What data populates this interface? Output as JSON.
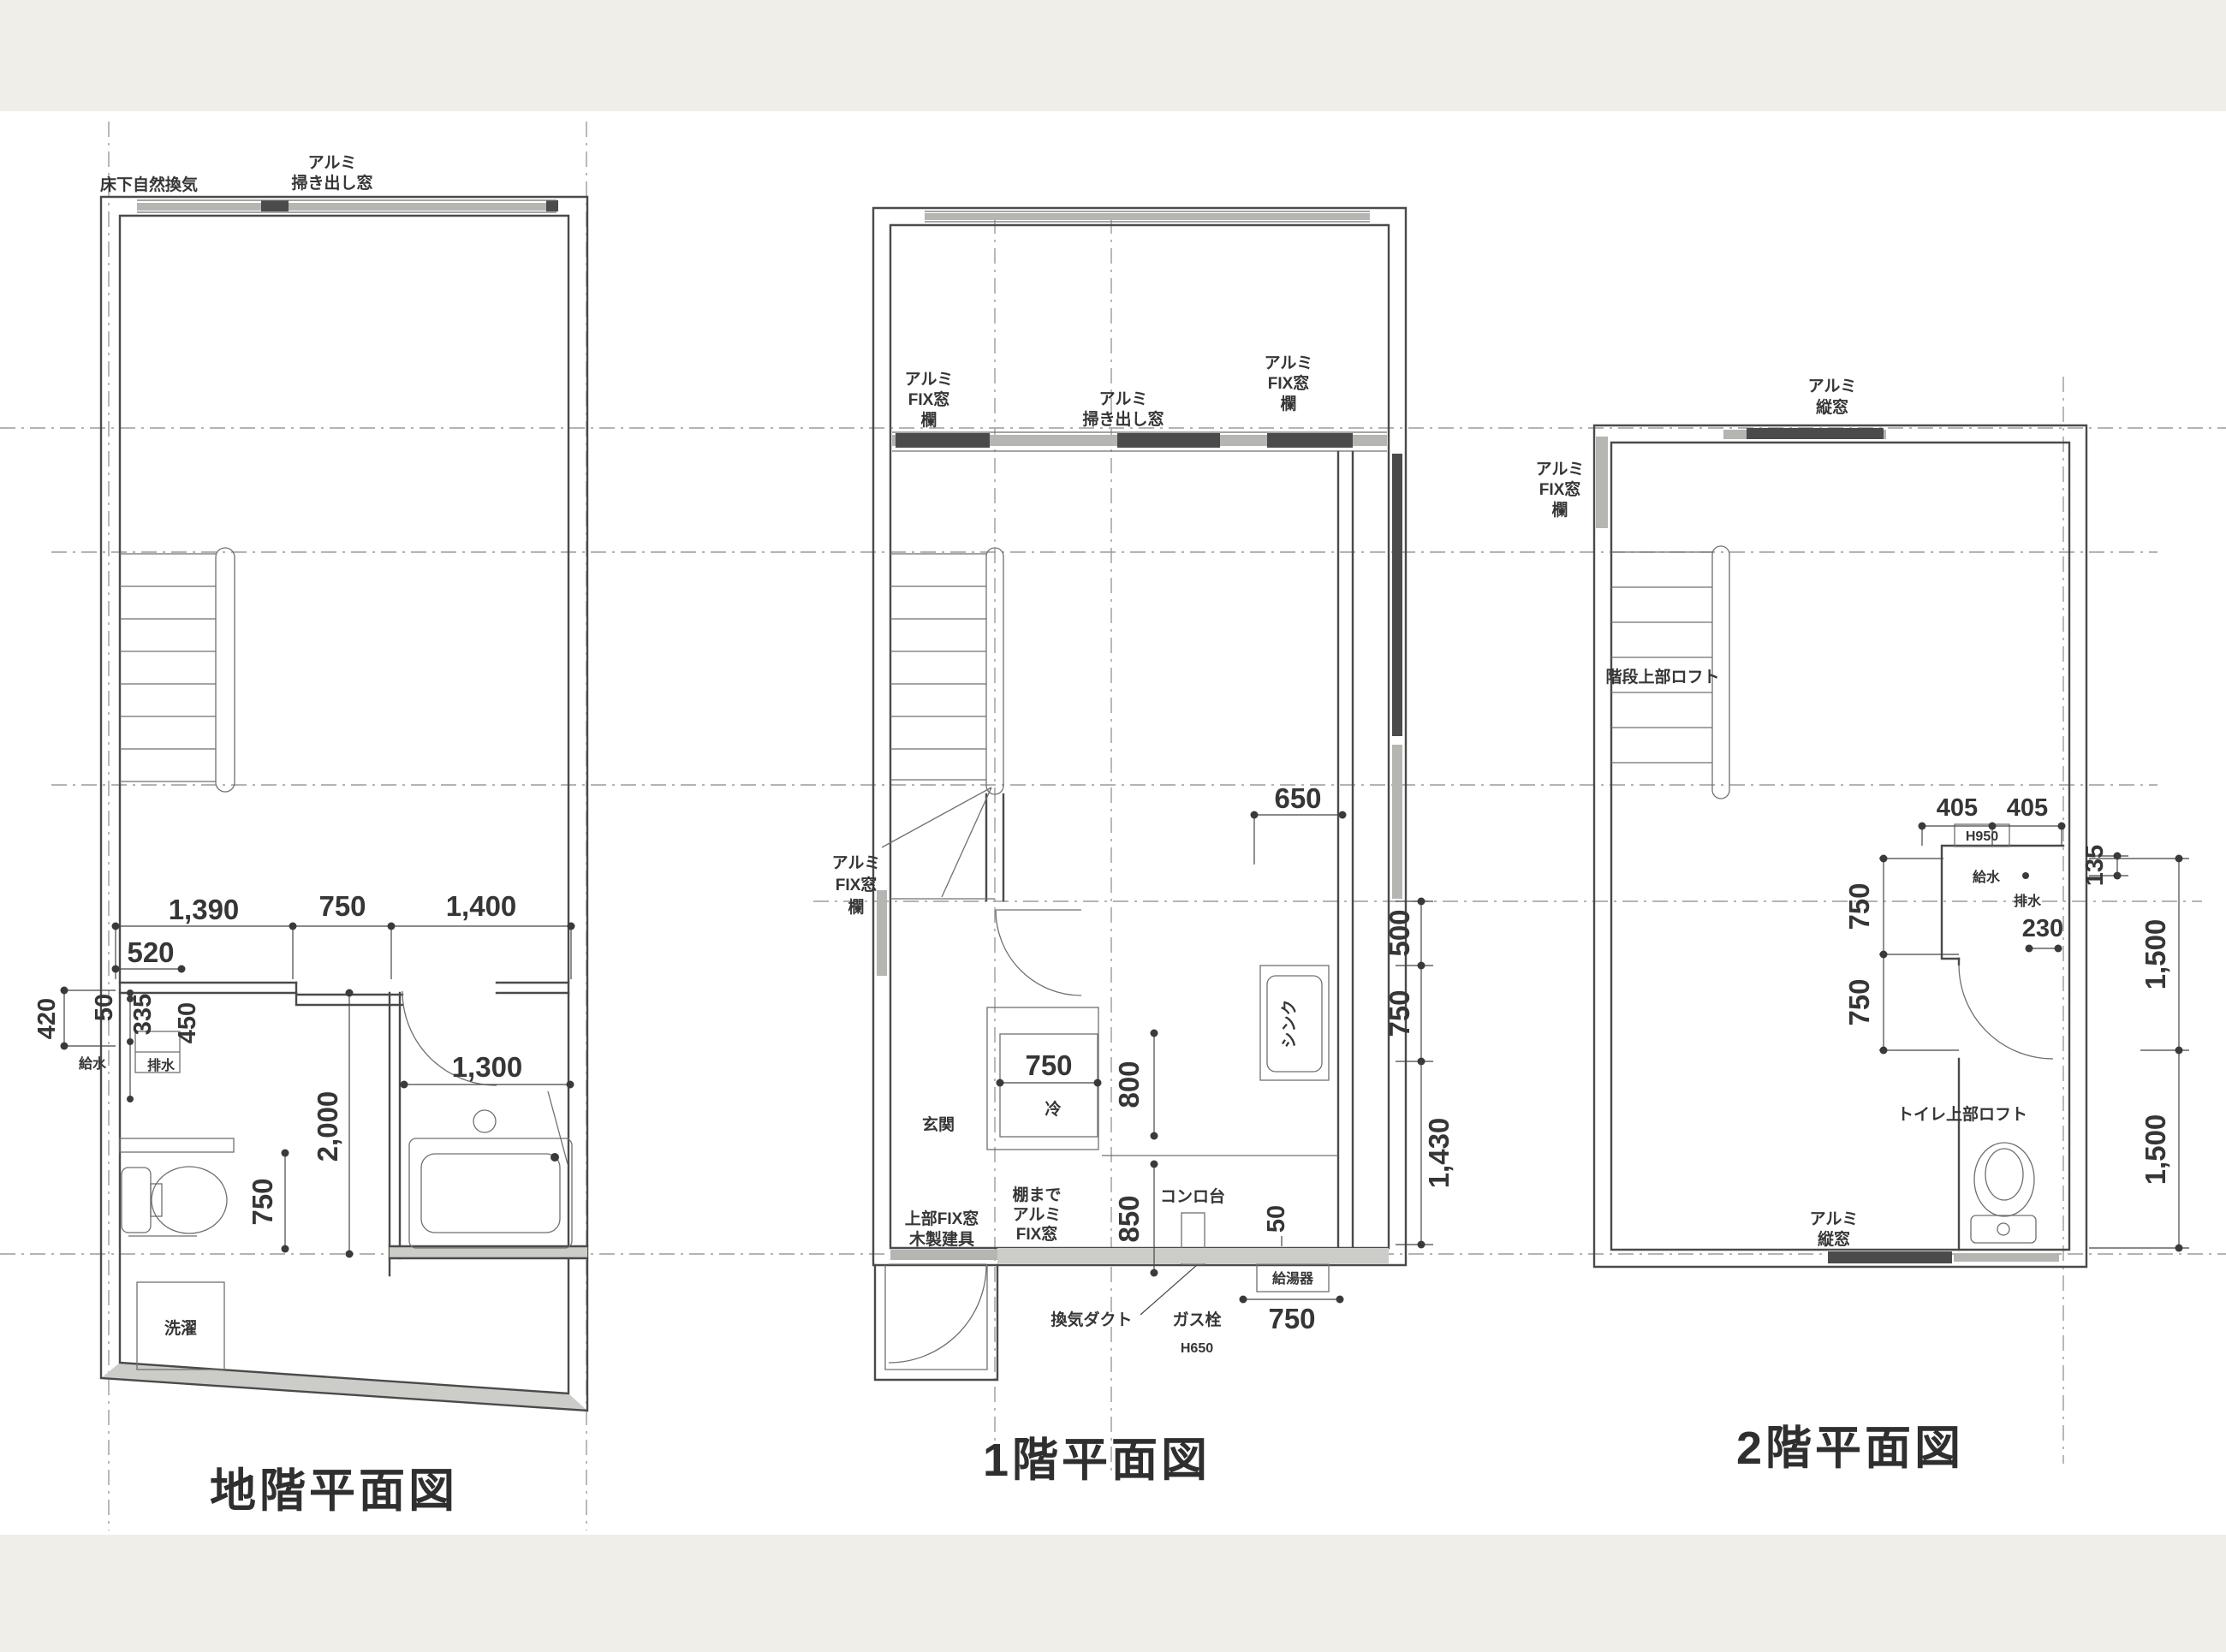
{
  "common": {
    "alumi": "アルミ",
    "fix_window": "FIX窓",
    "ran": "欄",
    "tate_window": "縦窓",
    "hakidashi_window": "掃き出し窓",
    "kyusui": "給水",
    "haisui": "排水"
  },
  "dims": {
    "d50": "50",
    "d135": "135",
    "d230": "230",
    "d335": "335",
    "d405": "405",
    "d420": "420",
    "d450": "450",
    "d500": "500",
    "d520": "520",
    "d650": "650",
    "d750": "750",
    "d800": "800",
    "d850": "850",
    "d1300": "1,300",
    "d1390": "1,390",
    "d1400": "1,400",
    "d1430": "1,430",
    "d1500": "1,500",
    "d2000": "2,000",
    "h650": "H650",
    "h950": "H950"
  },
  "basement": {
    "title": "地階平面図",
    "underfloor_vent": "床下自然換気",
    "laundry": "洗濯"
  },
  "floor1": {
    "title": "1階平面図",
    "entrance": "玄関",
    "fridge": "冷",
    "sink": "シンク",
    "stove": "コンロ台",
    "upper_fix_window": "上部FIX窓",
    "wooden_fitting": "木製建具",
    "to_shelf": "棚まで",
    "vent_duct": "換気ダクト",
    "gas_valve": "ガス栓",
    "water_heater": "給湯器"
  },
  "floor2": {
    "title": "2階平面図",
    "stair_loft": "階段上部ロフト",
    "toilet_loft": "トイレ上部ロフト"
  }
}
